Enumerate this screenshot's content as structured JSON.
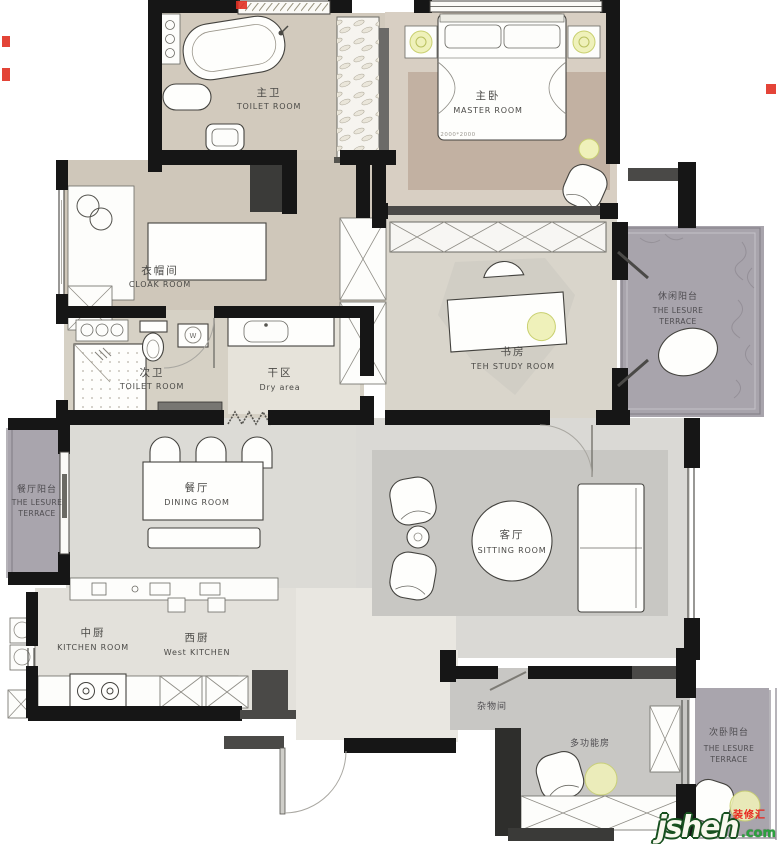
{
  "image_type": "residential floor plan",
  "rooms": {
    "master_bath": {
      "zh": "主卫",
      "en": "TOILET ROOM"
    },
    "master_room": {
      "zh": "主卧",
      "en": "MASTER ROOM",
      "bed_size": "2000*2000"
    },
    "cloak_room": {
      "zh": "衣帽间",
      "en": "CLOAK ROOM"
    },
    "study_room": {
      "zh": "书房",
      "en": "TEH STUDY ROOM"
    },
    "leisure_terrace": {
      "zh": "休闲阳台",
      "en1": "THE LESURE",
      "en2": "TERRACE"
    },
    "second_bath": {
      "zh": "次卫",
      "en": "TOILET ROOM"
    },
    "dry_area": {
      "zh": "干区",
      "en": "Dry area"
    },
    "dining_terrace": {
      "zh": "餐厅阳台",
      "en1": "THE LESURE",
      "en2": "TERRACE"
    },
    "dining_room": {
      "zh": "餐厅",
      "en": "DINING ROOM"
    },
    "sitting_room": {
      "zh": "客厅",
      "en": "SITTING ROOM"
    },
    "kitchen": {
      "zh": "中厨",
      "en": "KITCHEN ROOM"
    },
    "west_kitchen": {
      "zh": "西厨",
      "en": "West KITCHEN"
    },
    "storage": {
      "zh": "杂物间"
    },
    "multifunction": {
      "zh": "多功能房"
    },
    "bedroom_terrace": {
      "zh": "次卧阳台",
      "en1": "THE LESURE",
      "en2": "TERRACE"
    }
  },
  "symbols": {
    "washer": "W"
  },
  "watermark": {
    "name": "jsheh",
    "tld": ".com",
    "badge": "装修汇"
  },
  "colors": {
    "wall": "#161616",
    "floor_warm": "#d2cabd",
    "floor_master": "#d8cfc3",
    "carpet": "#c2b1a2",
    "floor_light": "#dcdbd6",
    "terrace": "#a8a4ac",
    "room_gray": "#c8c7c4",
    "lamp": "#eff1ba",
    "watermark_green": "#2ba23e",
    "watermark_red": "#e8251d"
  }
}
